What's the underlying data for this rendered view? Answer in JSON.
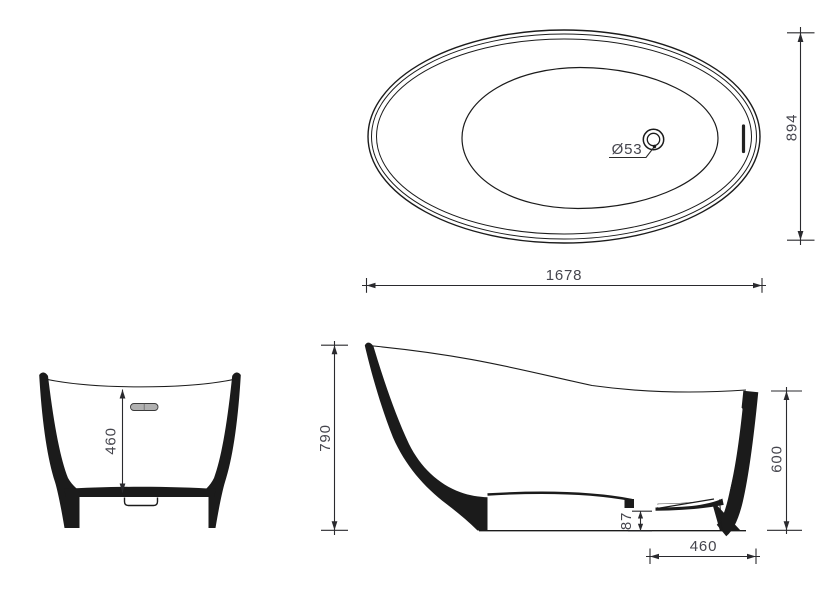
{
  "colors": {
    "background": "#ffffff",
    "line": "#1b1b1b",
    "dimension_text": "#45454d",
    "overflow_fill": "#b0b0b0"
  },
  "views": {
    "top": {
      "dims": {
        "length": "1678",
        "width": "894",
        "drain_diameter": "Ø53"
      }
    },
    "front": {
      "dims": {
        "inner_depth": "460"
      }
    },
    "side": {
      "dims": {
        "overall_height": "790",
        "rim_height": "600",
        "drain_outlet_height": "87",
        "base_length": "460"
      }
    }
  }
}
